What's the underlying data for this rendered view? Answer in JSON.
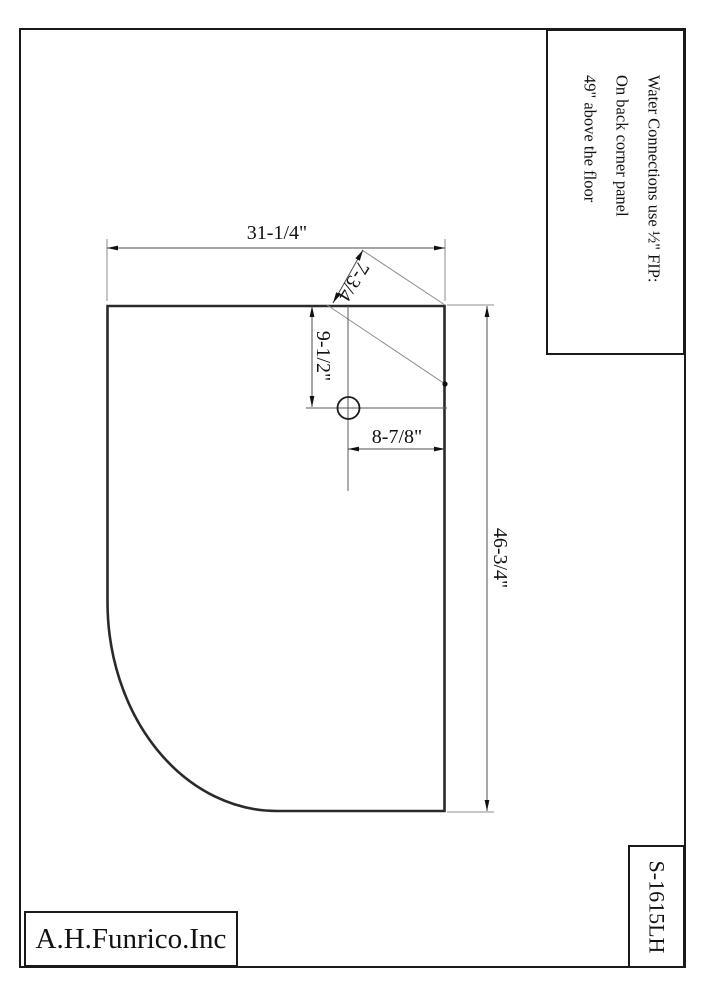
{
  "drawing": {
    "type": "corner shower base plan view",
    "ink_color": "#1a1a1a",
    "paper_color": "#ffffff"
  },
  "note": {
    "lines": [
      "Water Connections use ½\" FIP:",
      "On back corner panel",
      "49\" above the floor"
    ]
  },
  "dimensions": {
    "top_width": "31-1/4\"",
    "corner_panel_offset": "7-3/4",
    "hole_from_top": "9-1/2\"",
    "hole_from_side": "8-7/8\"",
    "side_depth": "46-3/4\""
  },
  "title_block": {
    "company": "A.H.Funrico.Inc",
    "model": "S-1615LH"
  }
}
